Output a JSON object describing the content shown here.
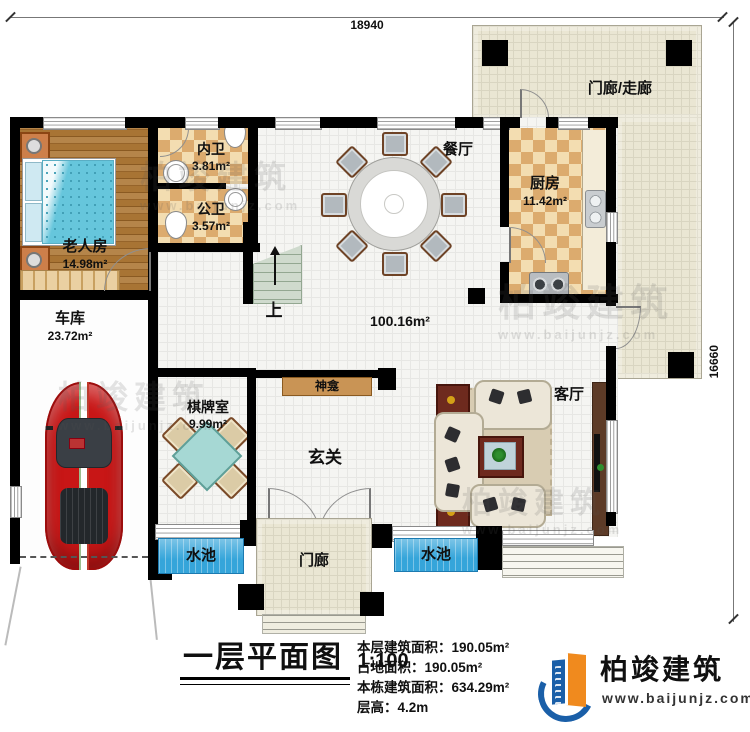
{
  "dimensions": {
    "width_label": "18940",
    "height_label": "16660"
  },
  "rooms": {
    "porch_walk": {
      "label": "门廊/走廊"
    },
    "dining": {
      "label": "餐厅"
    },
    "kitchen": {
      "label": "厨房",
      "area": "11.42m²"
    },
    "inner_bath": {
      "label": "内卫",
      "area": "3.81m²"
    },
    "public_bath": {
      "label": "公卫",
      "area": "3.57m²"
    },
    "elder_bedroom": {
      "label": "老人房",
      "area": "14.98m²"
    },
    "garage": {
      "label": "车库",
      "area": "23.72m²"
    },
    "chess_room": {
      "label": "棋牌室",
      "area": "9.99m²"
    },
    "shrine": {
      "label": "神龛"
    },
    "foyer": {
      "label": "玄关"
    },
    "living_room": {
      "label": "客厅"
    },
    "open_area": {
      "area": "100.16m²"
    },
    "pool_left": {
      "label": "水池"
    },
    "pool_right": {
      "label": "水池"
    },
    "entry_porch": {
      "label": "门廊"
    },
    "stairs": {
      "label": "上"
    }
  },
  "title_block": {
    "title": "一层平面图",
    "scale": "1:100",
    "lines": [
      "本层建筑面积：190.05m²",
      "占地面积：190.05m²",
      "本栋建筑面积：634.29m²",
      "层高：4.2m"
    ]
  },
  "branding": {
    "company": "柏竣建筑",
    "website": "www.baijunjz.com"
  },
  "watermarks": [
    {
      "text": "柏竣建筑",
      "sub": "www.baijunjz.com"
    },
    {
      "text": "柏竣建筑",
      "sub": "www.baijunjz.com"
    },
    {
      "text": "柏竣建筑",
      "sub": "www.baijunjz.com"
    },
    {
      "text": "柏竣建筑",
      "sub": "www.baijunjz.com"
    }
  ],
  "colors": {
    "wall": "#000000",
    "pool": "#35a5da",
    "wood": "#a87434",
    "checker": "#dcab6e",
    "porch_tile": "#eae6d3",
    "stair": "#cfdacd",
    "shrine_shelf": "#c99455",
    "logo_blue": "#1a5fa8",
    "logo_orange": "#f08a1e",
    "car": "#c81616",
    "bed": "#66c6dc"
  }
}
